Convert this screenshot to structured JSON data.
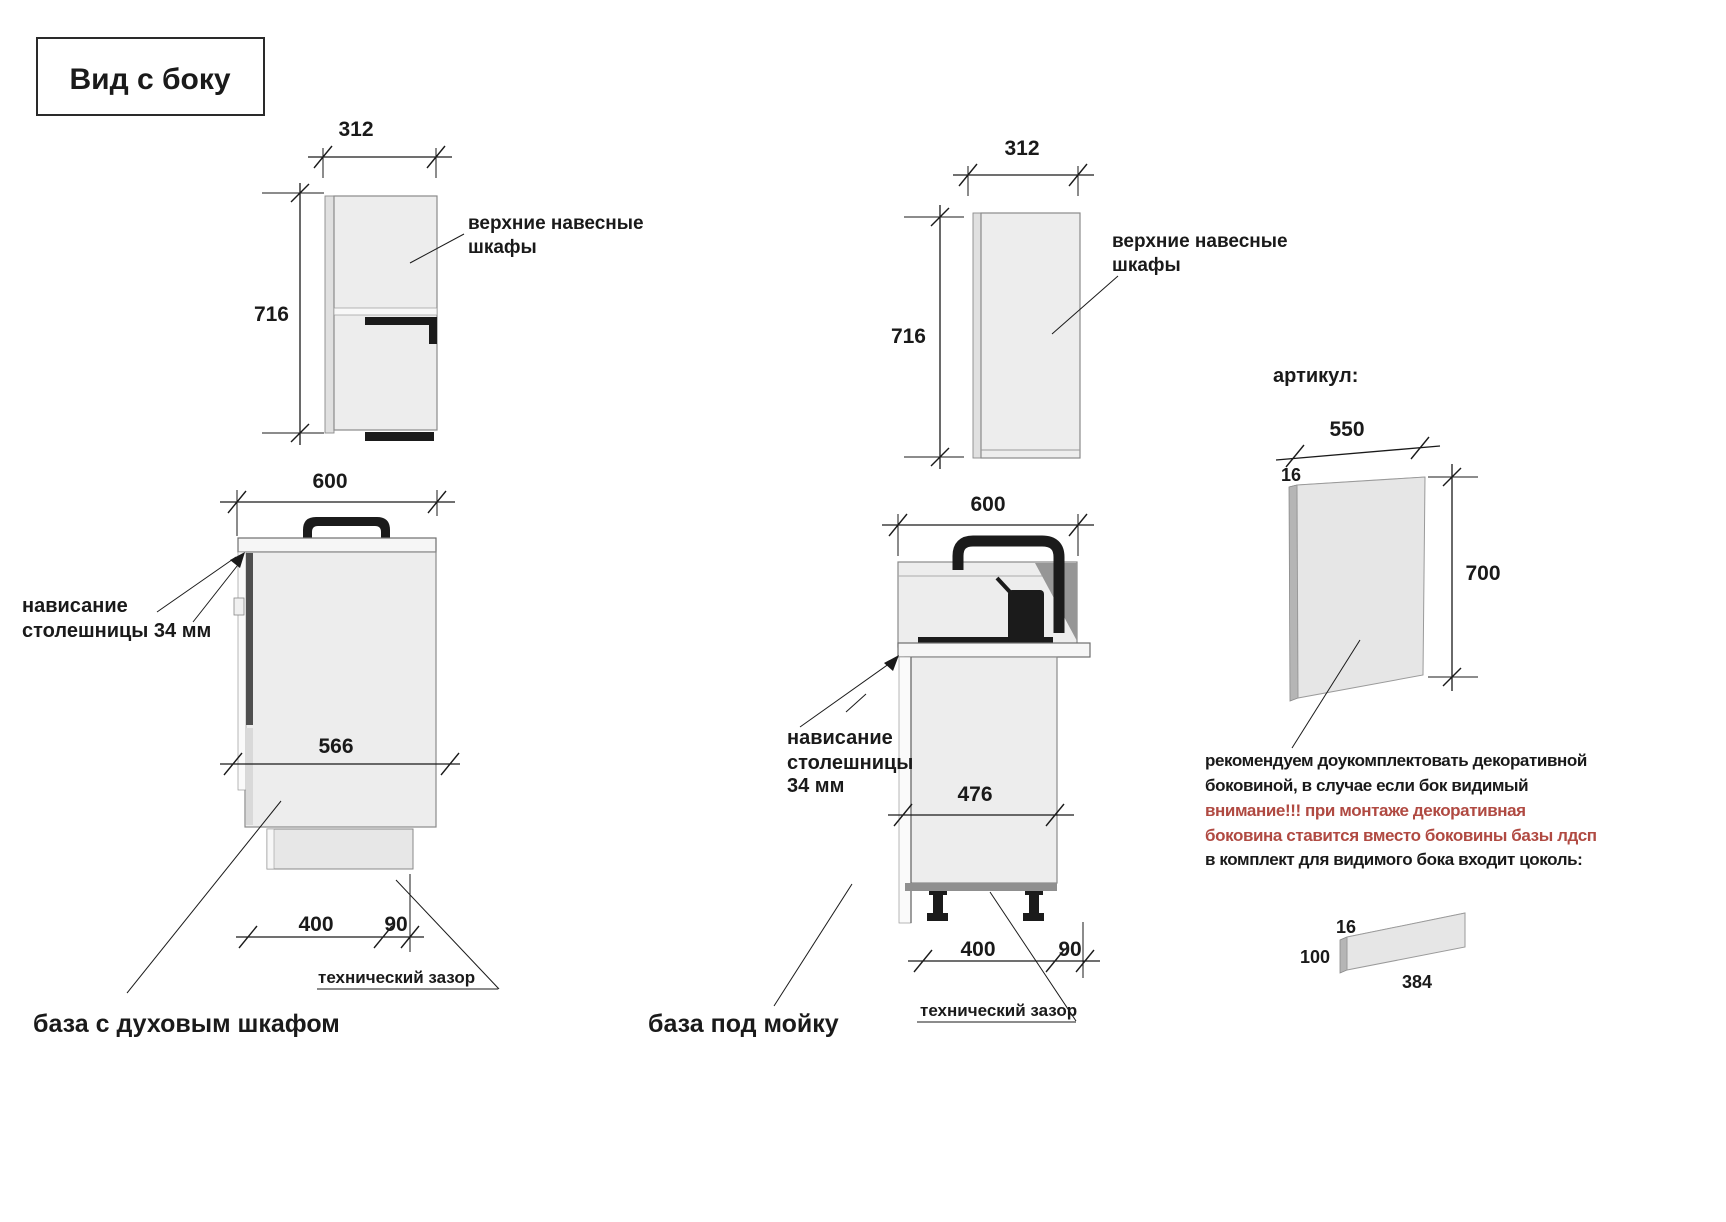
{
  "title": "Вид с боку",
  "figures": {
    "wall_left": {
      "width": "312",
      "height": "716",
      "label_line1": "верхние навесные",
      "label_line2": "шкафы"
    },
    "base_oven": {
      "top_width": "600",
      "inner_depth": "566",
      "bottom_width": "400",
      "gap": "90",
      "overhang_line1": "нависание",
      "overhang_line2": "столешницы 34 мм",
      "tech_gap": "технический зазор",
      "caption": "база с духовым шкафом"
    },
    "wall_mid": {
      "width": "312",
      "height": "716",
      "label_line1": "верхние навесные",
      "label_line2": "шкафы"
    },
    "base_sink": {
      "top_width": "600",
      "inner_depth": "476",
      "bottom_width": "400",
      "gap": "90",
      "overhang_line1": "нависание",
      "overhang_line2": "столешницы",
      "overhang_line3": "34 мм",
      "tech_gap": "технический зазор",
      "caption": "база под мойку"
    },
    "side_panel": {
      "article_label": "артикул:",
      "width": "550",
      "thickness": "16",
      "height": "700"
    },
    "note": {
      "line1": "рекомендуем доукомплектовать декоративной",
      "line2": "боковиной, в случае если бок видимый",
      "line3": "внимание!!! при монтаже декоративная",
      "line4": "боковина ставится вместо боковины базы лдсп",
      "line5": "в комплект для видимого бока входит цоколь:"
    },
    "plinth": {
      "thickness": "16",
      "height": "100",
      "length": "384"
    }
  },
  "colors": {
    "warning_red": "#b04a42",
    "line_black": "#1a1a1a",
    "cabinet_gray": "#ededed"
  }
}
